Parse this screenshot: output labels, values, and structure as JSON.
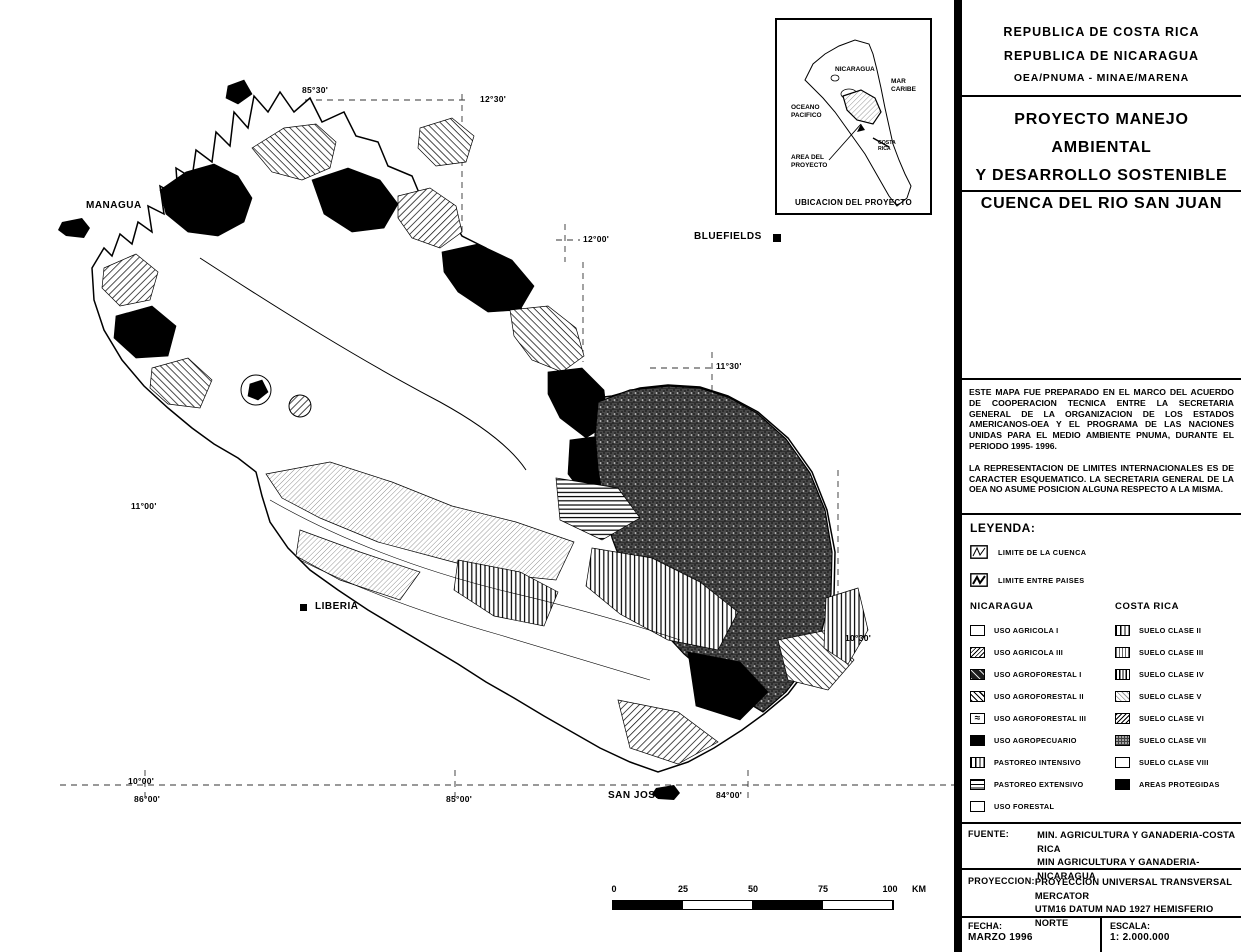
{
  "map": {
    "cities": {
      "managua": "MANAGUA",
      "bluefields": "BLUEFIELDS",
      "liberia": "LIBERIA",
      "san_jose": "SAN JOSE"
    },
    "graticule_labels": {
      "lon_85_30": "85°30'",
      "lat_12_30": "12°30'",
      "lat_12_00": "12°00'",
      "lat_11_30": "11°30'",
      "lat_11_00": "11°00'",
      "lat_10_30": "10°30'",
      "lat_10_00": "10°00'",
      "lon_86_00": "86°00'",
      "lon_85_00": "85°00'",
      "lon_84_00": "84°00'"
    },
    "inset": {
      "nicaragua": "NICARAGUA",
      "mar_caribe": "MAR CARIBE",
      "oceano_pacifico": "OCEANO PACIFICO",
      "area_del_proyecto": "AREA DEL PROYECTO",
      "costa_rica": "COSTA RICA",
      "caption": "UBICACION DEL PROYECTO"
    },
    "scale_bar": {
      "ticks": [
        "0",
        "25",
        "50",
        "75",
        "100"
      ],
      "unit": "KM"
    }
  },
  "panel": {
    "header": {
      "line1": "REPUBLICA DE COSTA RICA",
      "line2": "REPUBLICA DE NICARAGUA",
      "line3": "OEA/PNUMA - MINAE/MARENA"
    },
    "title": {
      "line1": "PROYECTO MANEJO AMBIENTAL",
      "line2": "Y DESARROLLO SOSTENIBLE",
      "line3": "CUENCA DEL RIO SAN JUAN"
    },
    "notes": {
      "para1": "ESTE MAPA FUE PREPARADO EN EL MARCO DEL ACUERDO DE COOPERACION TECNICA ENTRE LA SECRETARIA GENERAL DE LA ORGANIZACION DE LOS ESTADOS AMERICANOS-OEA Y EL PROGRAMA DE LAS NACIONES UNIDAS PARA EL MEDIO AMBIENTE PNUMA, DURANTE EL PERIODO 1995- 1996.",
      "para2": "LA REPRESENTACION DE LIMITES INTERNACIONALES ES DE CARACTER ESQUEMATICO. LA SECRETARIA GENERAL DE LA OEA NO ASUME POSICION ALGUNA RESPECTO A LA MISMA."
    },
    "legend": {
      "heading": "LEYENDA:",
      "boundary_symbols": [
        {
          "label": "LIMITE DE LA CUENCA"
        },
        {
          "label": "LIMITE ENTRE PAISES"
        }
      ],
      "nicaragua": {
        "heading": "NICARAGUA",
        "items": [
          {
            "label": "USO AGRICOLA I",
            "pattern": "blank"
          },
          {
            "label": "USO AGRICOLA III",
            "pattern": "diagonal-hatch-fine"
          },
          {
            "label": "USO AGROFORESTAL I",
            "pattern": "dark-mottled"
          },
          {
            "label": "USO AGROFORESTAL II",
            "pattern": "diagonal-hatch"
          },
          {
            "label": "USO AGROFORESTAL III",
            "pattern": "squiggle"
          },
          {
            "label": "USO AGROPECUARIO",
            "pattern": "solid-black"
          },
          {
            "label": "PASTOREO INTENSIVO",
            "pattern": "vertical-lines"
          },
          {
            "label": "PASTOREO EXTENSIVO",
            "pattern": "horizontal-lines"
          },
          {
            "label": "USO FORESTAL",
            "pattern": "blank"
          }
        ]
      },
      "costa_rica": {
        "heading": "COSTA RICA",
        "items": [
          {
            "label": "SUELO CLASE II",
            "pattern": "vertical-lines"
          },
          {
            "label": "SUELO CLASE III",
            "pattern": "vertical-lines-fine"
          },
          {
            "label": "SUELO CLASE IV",
            "pattern": "vertical-lines-dense"
          },
          {
            "label": "SUELO CLASE V",
            "pattern": "diagonal-hatch-light"
          },
          {
            "label": "SUELO CLASE VI",
            "pattern": "diagonal-hatch-dense"
          },
          {
            "label": "SUELO CLASE VII",
            "pattern": "dark-stipple"
          },
          {
            "label": "SUELO CLASE VIII",
            "pattern": "blank"
          },
          {
            "label": "AREAS PROTEGIDAS",
            "pattern": "solid-black"
          }
        ]
      }
    },
    "fuente": {
      "label": "FUENTE:",
      "line1": "MIN. AGRICULTURA Y GANADERIA-COSTA RICA",
      "line2": "MIN AGRICULTURA Y GANADERIA-NICARAGUA"
    },
    "proyeccion": {
      "label": "PROYECCION:",
      "line1": "PROYECCION UNIVERSAL TRANSVERSAL MERCATOR",
      "line2": "UTM16 DATUM NAD 1927 HEMISFERIO NORTE"
    },
    "fecha": {
      "label": "FECHA:",
      "value": "MARZO 1996"
    },
    "escala": {
      "label": "ESCALA:",
      "value": "1: 2.000.000"
    }
  }
}
